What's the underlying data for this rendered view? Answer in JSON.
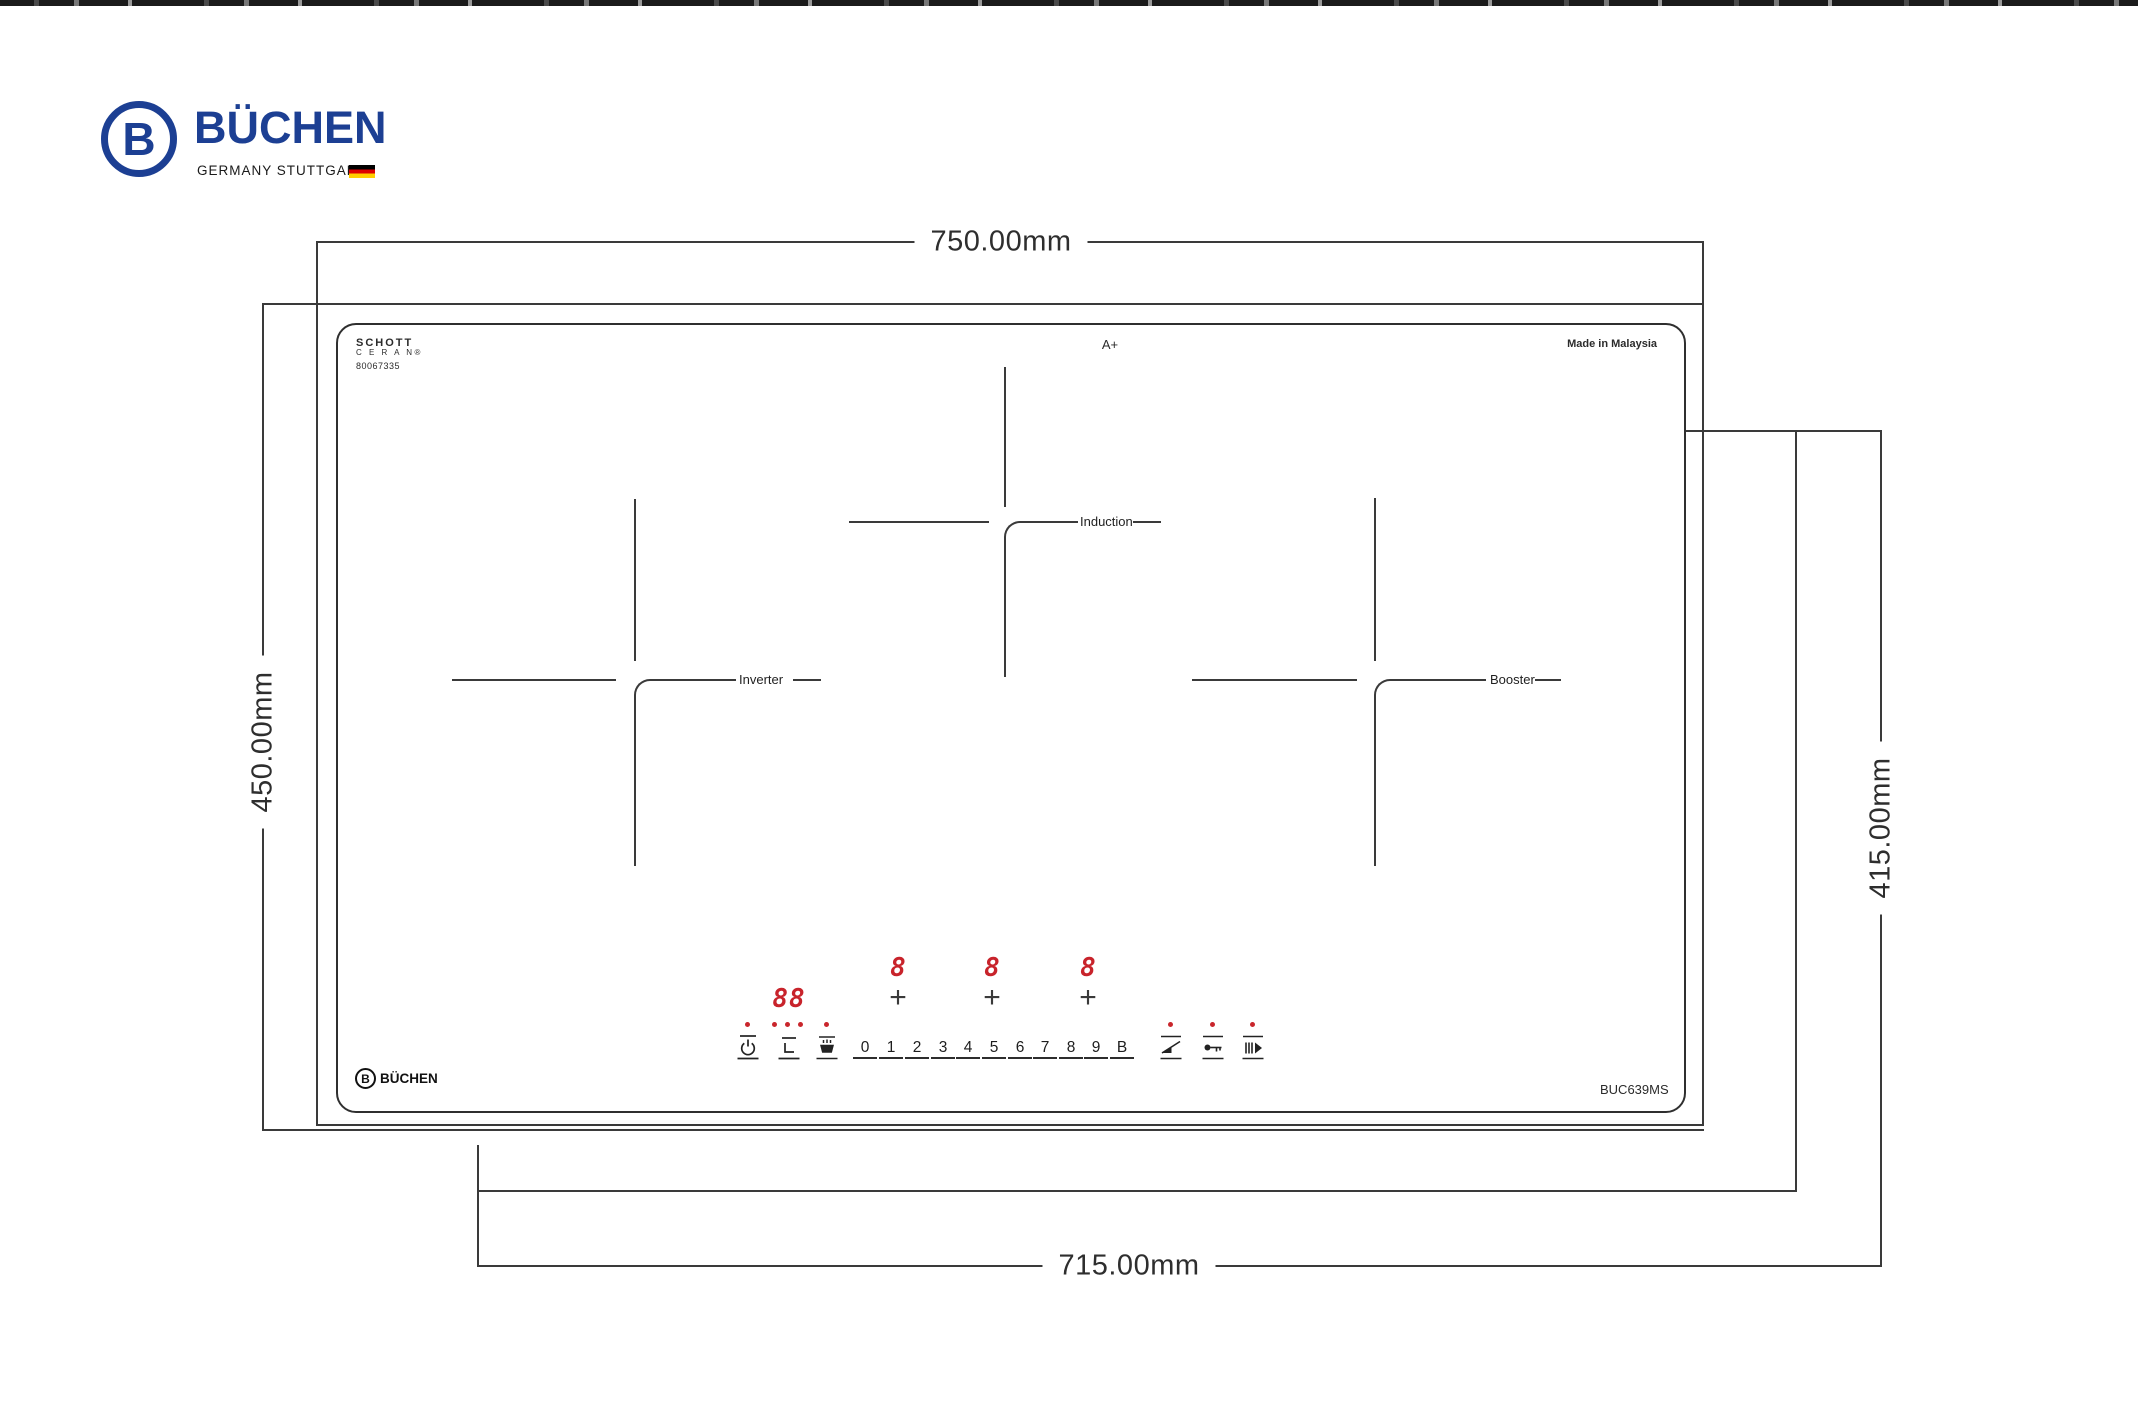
{
  "brand": {
    "name": "BÜCHEN",
    "monogram": "B",
    "tagline": "GERMANY STUTTGART",
    "color": "#1c3f93",
    "flag_colors": [
      "#000000",
      "#dd0000",
      "#ffce00"
    ]
  },
  "dimensions": {
    "glass_width": "750.00mm",
    "glass_depth": "450.00mm",
    "cutout_width": "715.00mm",
    "cutout_depth": "415.00mm"
  },
  "glass": {
    "maker_line1": "SCHOTT",
    "maker_line2": "C E R A N®",
    "serial": "80067335",
    "energy_rating": "A+",
    "origin": "Made in Malaysia",
    "model": "BUC639MS",
    "brand_name": "BÜCHEN",
    "brand_monogram": "B"
  },
  "zones": {
    "left": "Inverter",
    "middle": "Induction",
    "right": "Booster"
  },
  "control_panel": {
    "timer_display": "88",
    "zone_display_1": "8",
    "zone_display_2": "8",
    "zone_display_3": "8",
    "plus": "+",
    "keys": [
      "0",
      "1",
      "2",
      "3",
      "4",
      "5",
      "6",
      "7",
      "8",
      "9",
      "B"
    ],
    "display_color": "#c8232b",
    "icons": {
      "power": "power-icon",
      "timer": "timer-icon",
      "keep_warm": "keep-warm-icon",
      "flex": "flex-zone-icon",
      "child_lock": "child-lock-key-icon",
      "pause": "pause-play-icon"
    }
  }
}
